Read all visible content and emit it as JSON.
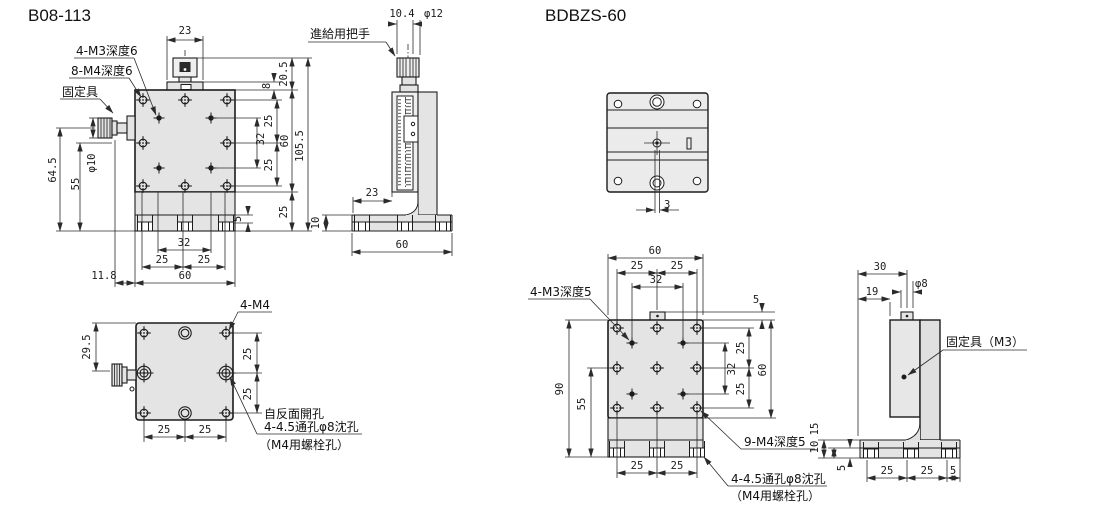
{
  "palette": {
    "background": "#ffffff",
    "part_fill": "#e4e4e4",
    "line": "#1c1c1c",
    "dim_line": "#2b2b2b"
  },
  "b08113": {
    "title": "B08-113",
    "front": {
      "dim_23": "23",
      "label_m3": "4-M3深度6",
      "label_m4": "8-M4深度6",
      "label_clamp": "固定具",
      "dim_64_5": "64.5",
      "dim_55": "55",
      "dim_phi10": "φ10",
      "dim_20_5": "20.5",
      "dim_8": "8",
      "dim_25_r1": "25",
      "dim_32_right": "32",
      "dim_25_r2": "25",
      "dim_60_right": "60",
      "dim_105_5": "105.5",
      "dim_5": "5",
      "dim_25_base": "25",
      "dim_32_bottom": "32",
      "dim_25_b1": "25",
      "dim_25_b2": "25",
      "dim_11_8": "11.8",
      "dim_60_bottom": "60"
    },
    "side": {
      "dim_10_4": "10.4",
      "dim_phi12": "φ12",
      "label_handle": "進給用把手",
      "dim_23": "23",
      "dim_10": "10",
      "dim_60": "60"
    },
    "bottom": {
      "label_4m4": "4-M4",
      "dim_29_5": "29.5",
      "dim_25_r1": "25",
      "dim_25_r2": "25",
      "dim_25_b1": "25",
      "dim_25_b2": "25",
      "note_line1": "自反面開孔",
      "note_line2": "4-4.5通孔φ8沈孔",
      "note_line3": "（M4用螺栓孔）"
    }
  },
  "bdbzs60": {
    "title": "BDBZS-60",
    "top": {
      "dim_3": "3"
    },
    "front": {
      "dim_60_top": "60",
      "dim_25_t1": "25",
      "dim_25_t2": "25",
      "dim_32_top": "32",
      "label_m3": "4-M3深度5",
      "dim_90": "90",
      "dim_55": "55",
      "dim_5_tab": "5",
      "dim_32_right": "32",
      "dim_25_r1": "25",
      "dim_25_r2": "25",
      "dim_60_right": "60",
      "dim_25_b1": "25",
      "dim_25_b2": "25",
      "label_m4": "9-M4深度5",
      "note_line1": "4-4.5通孔φ8沈孔",
      "note_line2": "（M4用螺栓孔）"
    },
    "side": {
      "dim_30": "30",
      "dim_19": "19",
      "dim_phi8": "φ8",
      "label_clamp": "固定具（M3）",
      "dim_15": "15",
      "dim_10": "10",
      "dim_5_left": "5",
      "dim_25_b1": "25",
      "dim_25_b2": "25",
      "dim_5_b": "5"
    }
  }
}
